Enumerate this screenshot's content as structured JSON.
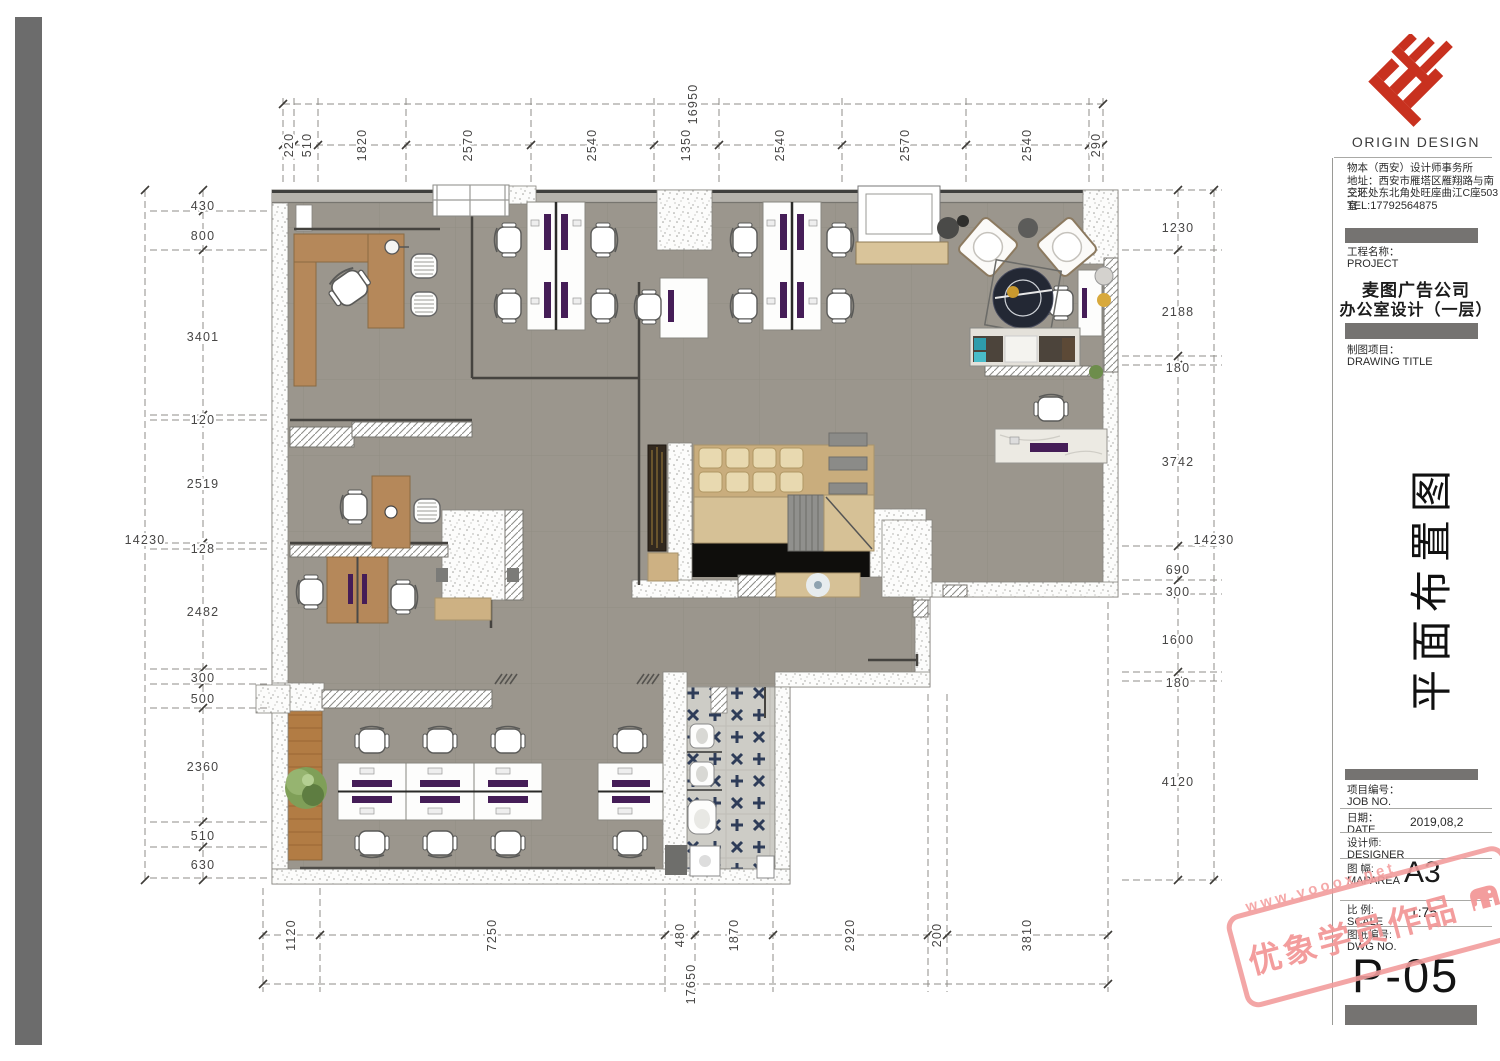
{
  "brand": {
    "name": "ORIGIN DESIGN",
    "firm": "物本（西安）设计师事务所",
    "address_line1": "地址：西安市雁塔区雁翔路与南三环",
    "address_line2": "交汇处东北角处旺座曲江C座503室",
    "tel": "TEL:17792564875"
  },
  "project": {
    "label_cn": "工程名称：",
    "label_en": "PROJECT",
    "name_line1": "麦图广告公司",
    "name_line2": "办公室设计（一层）"
  },
  "drawing": {
    "label_cn": "制图项目：",
    "label_en": "DRAWING TITLE",
    "title_vertical": "平面布置图"
  },
  "titleblock": {
    "job_label_cn": "项目编号：",
    "job_label_en": "JOB NO.",
    "date_label_cn": "日期：",
    "date_label_en": "DATE",
    "date_value": "2019,08,2",
    "designer_label_cn": "设计师:",
    "designer_label_en": "DESIGNER",
    "maparea_label_cn": "图  幅:",
    "maparea_label_en": "MAPAREA",
    "maparea_value": "A3",
    "scale_label_cn": "比  例:",
    "scale_label_en": "SCALE",
    "scale_value": "1:75",
    "dwg_label_cn": "图纸编号:",
    "dwg_label_en": "DWG NO.",
    "dwg_value": "P-05"
  },
  "watermark": {
    "stamp_text": "优象学员作品",
    "url": "www.yooox.net"
  },
  "colors": {
    "accent_red": "#c8311f",
    "stamp_pink": "#f29c9c",
    "floor_gray": "#9b968d"
  },
  "dimensions": {
    "top": {
      "overall": "16950",
      "segments": [
        "220",
        "510",
        "1820",
        "2570",
        "2540",
        "1350",
        "2540",
        "2570",
        "2540",
        "290"
      ]
    },
    "bottom": {
      "overall": "17650",
      "segments": [
        "1120",
        "7250",
        "480",
        "1870",
        "2920",
        "200",
        "3810"
      ]
    },
    "left": {
      "overall": "14230",
      "segments": [
        "430",
        "800",
        "3401",
        "120",
        "2519",
        "128",
        "2482",
        "300",
        "500",
        "2360",
        "510",
        "630"
      ]
    },
    "right": {
      "overall": "14230",
      "segments": [
        "1230",
        "2188",
        "180",
        "3742",
        "690",
        "300",
        "1600",
        "180",
        "4120"
      ]
    }
  }
}
